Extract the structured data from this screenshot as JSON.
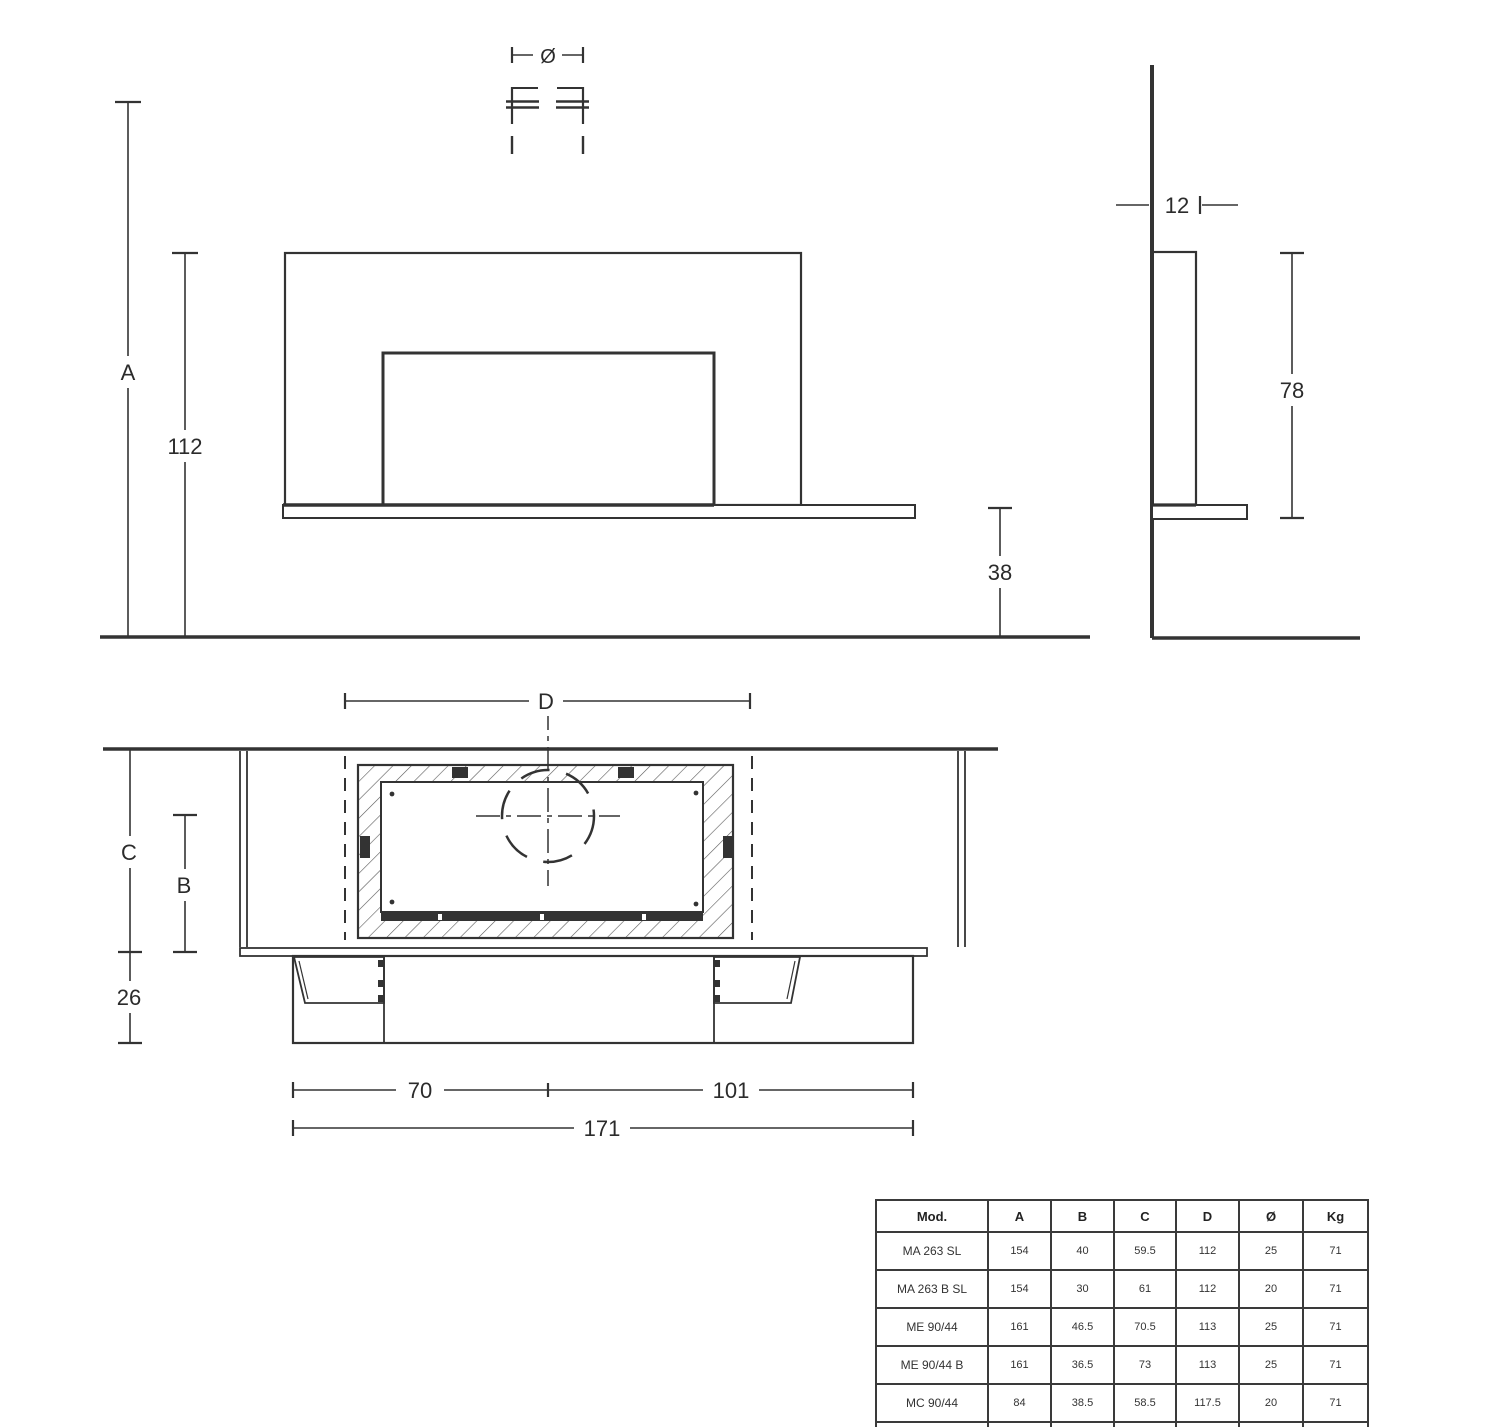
{
  "labels": {
    "a": "A",
    "h112": "112",
    "h38": "38",
    "diameter": "Ø",
    "w12": "12",
    "h78": "78",
    "d": "D",
    "c": "C",
    "b": "B",
    "n26": "26",
    "n70": "70",
    "n101": "101",
    "n171": "171"
  },
  "table": {
    "columns": [
      "Mod.",
      "A",
      "B",
      "C",
      "D",
      "Ø",
      "Kg"
    ],
    "rows": [
      [
        "MA 263 SL",
        "154",
        "40",
        "59.5",
        "112",
        "25",
        "71"
      ],
      [
        "MA 263 B SL",
        "154",
        "30",
        "61",
        "112",
        "20",
        "71"
      ],
      [
        "ME 90/44",
        "161",
        "46.5",
        "70.5",
        "113",
        "25",
        "71"
      ],
      [
        "ME 90/44 B",
        "161",
        "36.5",
        "73",
        "113",
        "25",
        "71"
      ],
      [
        "MC 90/44",
        "84",
        "38.5",
        "58.5",
        "117.5",
        "20",
        "71"
      ],
      [
        "IG 90",
        "91.5",
        "32.5",
        "50",
        "102",
        "15",
        "71"
      ]
    ]
  },
  "colors": {
    "line": "#333333",
    "text": "#2b2b2b",
    "table_border": "#3a3a3a",
    "background": "#ffffff"
  }
}
